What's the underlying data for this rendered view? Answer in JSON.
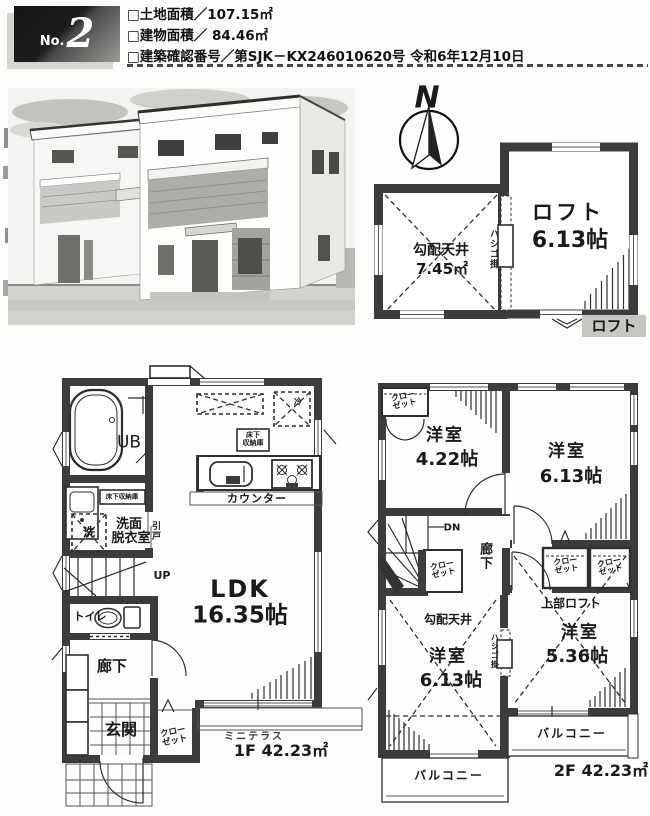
{
  "header": {
    "badge_prefix": "No.",
    "badge_number": "2",
    "land_area": "□土地面積／107.15㎡",
    "building_area": "□建物面積／ 84.46㎡",
    "confirmation": "□建築確認番号／第SJK－KX246010620号 令和6年12月10日"
  },
  "compass": {
    "north": "N"
  },
  "loft": {
    "sloped_ceiling": "勾配天井",
    "sloped_area": "7.45㎡",
    "ladder": "ハシゴ掛",
    "name": "ロフト",
    "size": "6.13帖",
    "tag": "ロフト"
  },
  "f1": {
    "ub": "UB",
    "underfloor_storage": "床下収納庫",
    "storage_l1": "床下",
    "storage_l2": "収納庫",
    "fridge": "冷",
    "counter": "カウンター",
    "washer": "洗",
    "washroom_l1": "洗面",
    "washroom_l2": "脱衣室",
    "sliding_door": "引戸",
    "up": "UP",
    "toilet": "トイレ",
    "hall": "廊下",
    "ldk": "LDK",
    "ldk_size": "16.35帖",
    "entrance": "玄関",
    "closet_l1": "クロー",
    "closet_l2": "ゼット",
    "mini_terrace": "ミニテラス",
    "area": "1F 42.23㎡"
  },
  "f2": {
    "closet_l1": "クロー",
    "closet_l2": "ゼット",
    "room_nw": "洋室",
    "room_nw_size": "4.22帖",
    "room_ne": "洋室",
    "room_ne_size": "6.13帖",
    "dn": "DN",
    "hall": "廊下",
    "sloped_ceiling": "勾配天井",
    "ladder": "ハシゴ掛",
    "upper_loft": "上部ロフト",
    "room_sw": "洋室",
    "room_sw_size": "6.13帖",
    "room_se": "洋室",
    "room_se_size": "5.36帖",
    "balcony_right": "バルコニー",
    "balcony_left": "バルコニー",
    "area": "2F 42.23㎡"
  }
}
